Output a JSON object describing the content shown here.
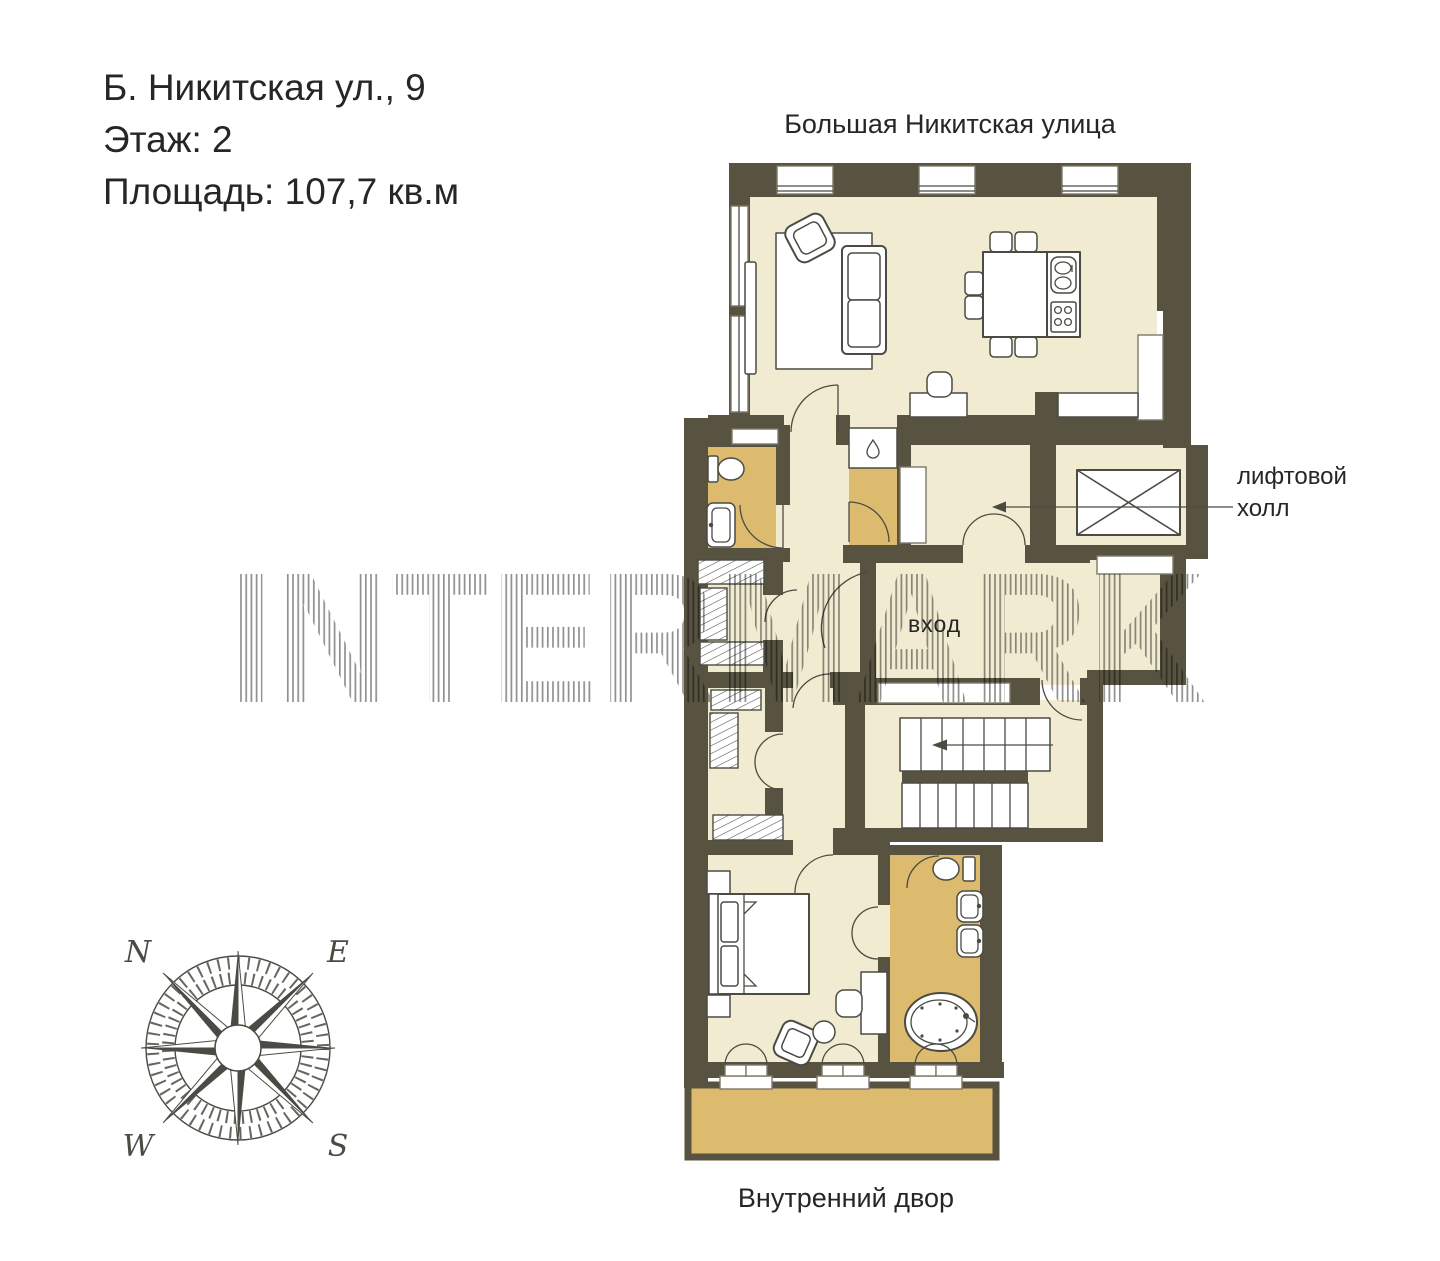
{
  "title_block": {
    "address": "Б. Никитская ул., 9",
    "floor": "Этаж: 2",
    "area": "Площадь: 107,7 кв.м"
  },
  "labels": {
    "street_top": "Большая Никитская улица",
    "courtyard_bottom": "Внутренний двор",
    "lift_hall_line1": "лифтовой",
    "lift_hall_line2": "холл",
    "entrance": "вход"
  },
  "watermark": {
    "text": "INTERMARK"
  },
  "compass": {
    "n": "N",
    "e": "E",
    "w": "W",
    "s": "S"
  },
  "icons": {
    "compass_rose": "compass-rose-icon",
    "elevator": "elevator-shaft-icon",
    "stairs": "staircase-icon"
  },
  "colors": {
    "wall": "#575340",
    "floor": "#f1ecd1",
    "wet_floor": "#dcba6e",
    "line": "#4b4b44",
    "text": "#262626",
    "watermark_stripe": "#909090",
    "background": "#ffffff"
  }
}
